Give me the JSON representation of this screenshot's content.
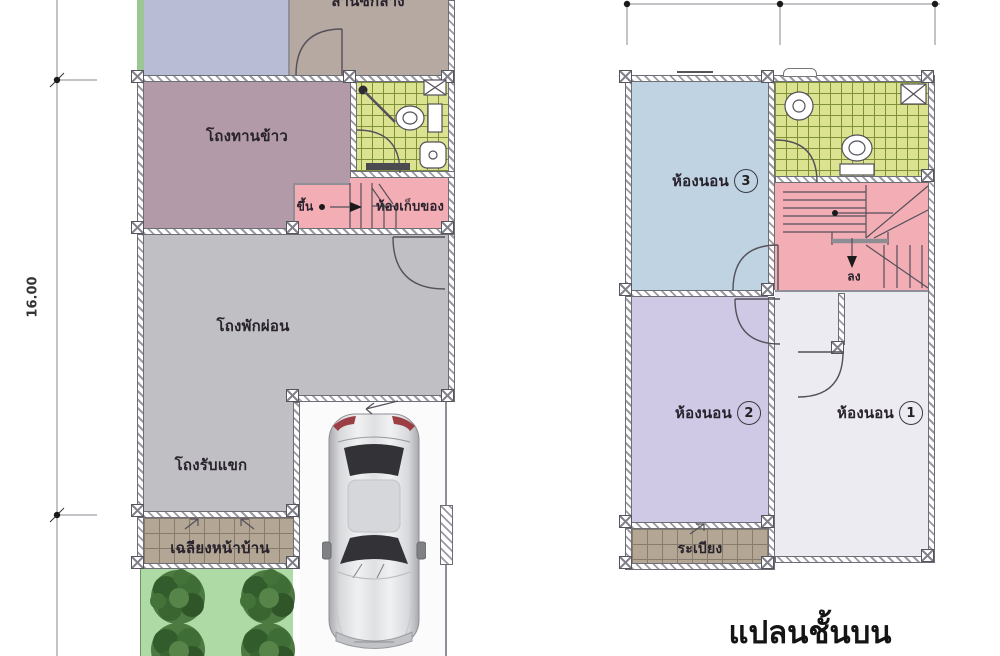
{
  "title": "แปลนชั้นบน",
  "dimensions": {
    "plot_height_m": "16.00"
  },
  "ground_floor": {
    "washing_area": "ลานซักล้าง",
    "dining_hall": "โถงทานข้าว",
    "stairs_up": "ขึ้น",
    "storage_room": "ห้องเก็บของ",
    "living_hall": "โถงพักผ่อน",
    "guest_hall": "โถงรับแขก",
    "front_porch": "เฉลียงหน้าบ้าน"
  },
  "upper_floor": {
    "bedroom_label": "ห้องนอน",
    "bedroom1_number": "1",
    "bedroom2_number": "2",
    "bedroom3_number": "3",
    "stairs_down": "ลง",
    "balcony": "ระเบียง"
  },
  "icons": {
    "car": "car-top-view",
    "tree": "round-tree",
    "toilet": "toilet-top-view",
    "sink": "sink-top-view",
    "shower": "shower-head",
    "vanity": "crossed-box"
  },
  "colors": {
    "dining": "#b29aa9",
    "living": "#c0c0c4",
    "bathroom_tile": "#dbe290",
    "stairs_pink": "#f3adb5",
    "bedroom3_blue": "#bfd3e3",
    "bedroom2_purple": "#cfc9e6",
    "bedroom1_white": "#ebebf1",
    "porch_tan": "#b3a695",
    "garden_green": "#aedaa6",
    "yard_blue": "#b8bcd5",
    "washing_taupe": "#b5a9a1"
  }
}
